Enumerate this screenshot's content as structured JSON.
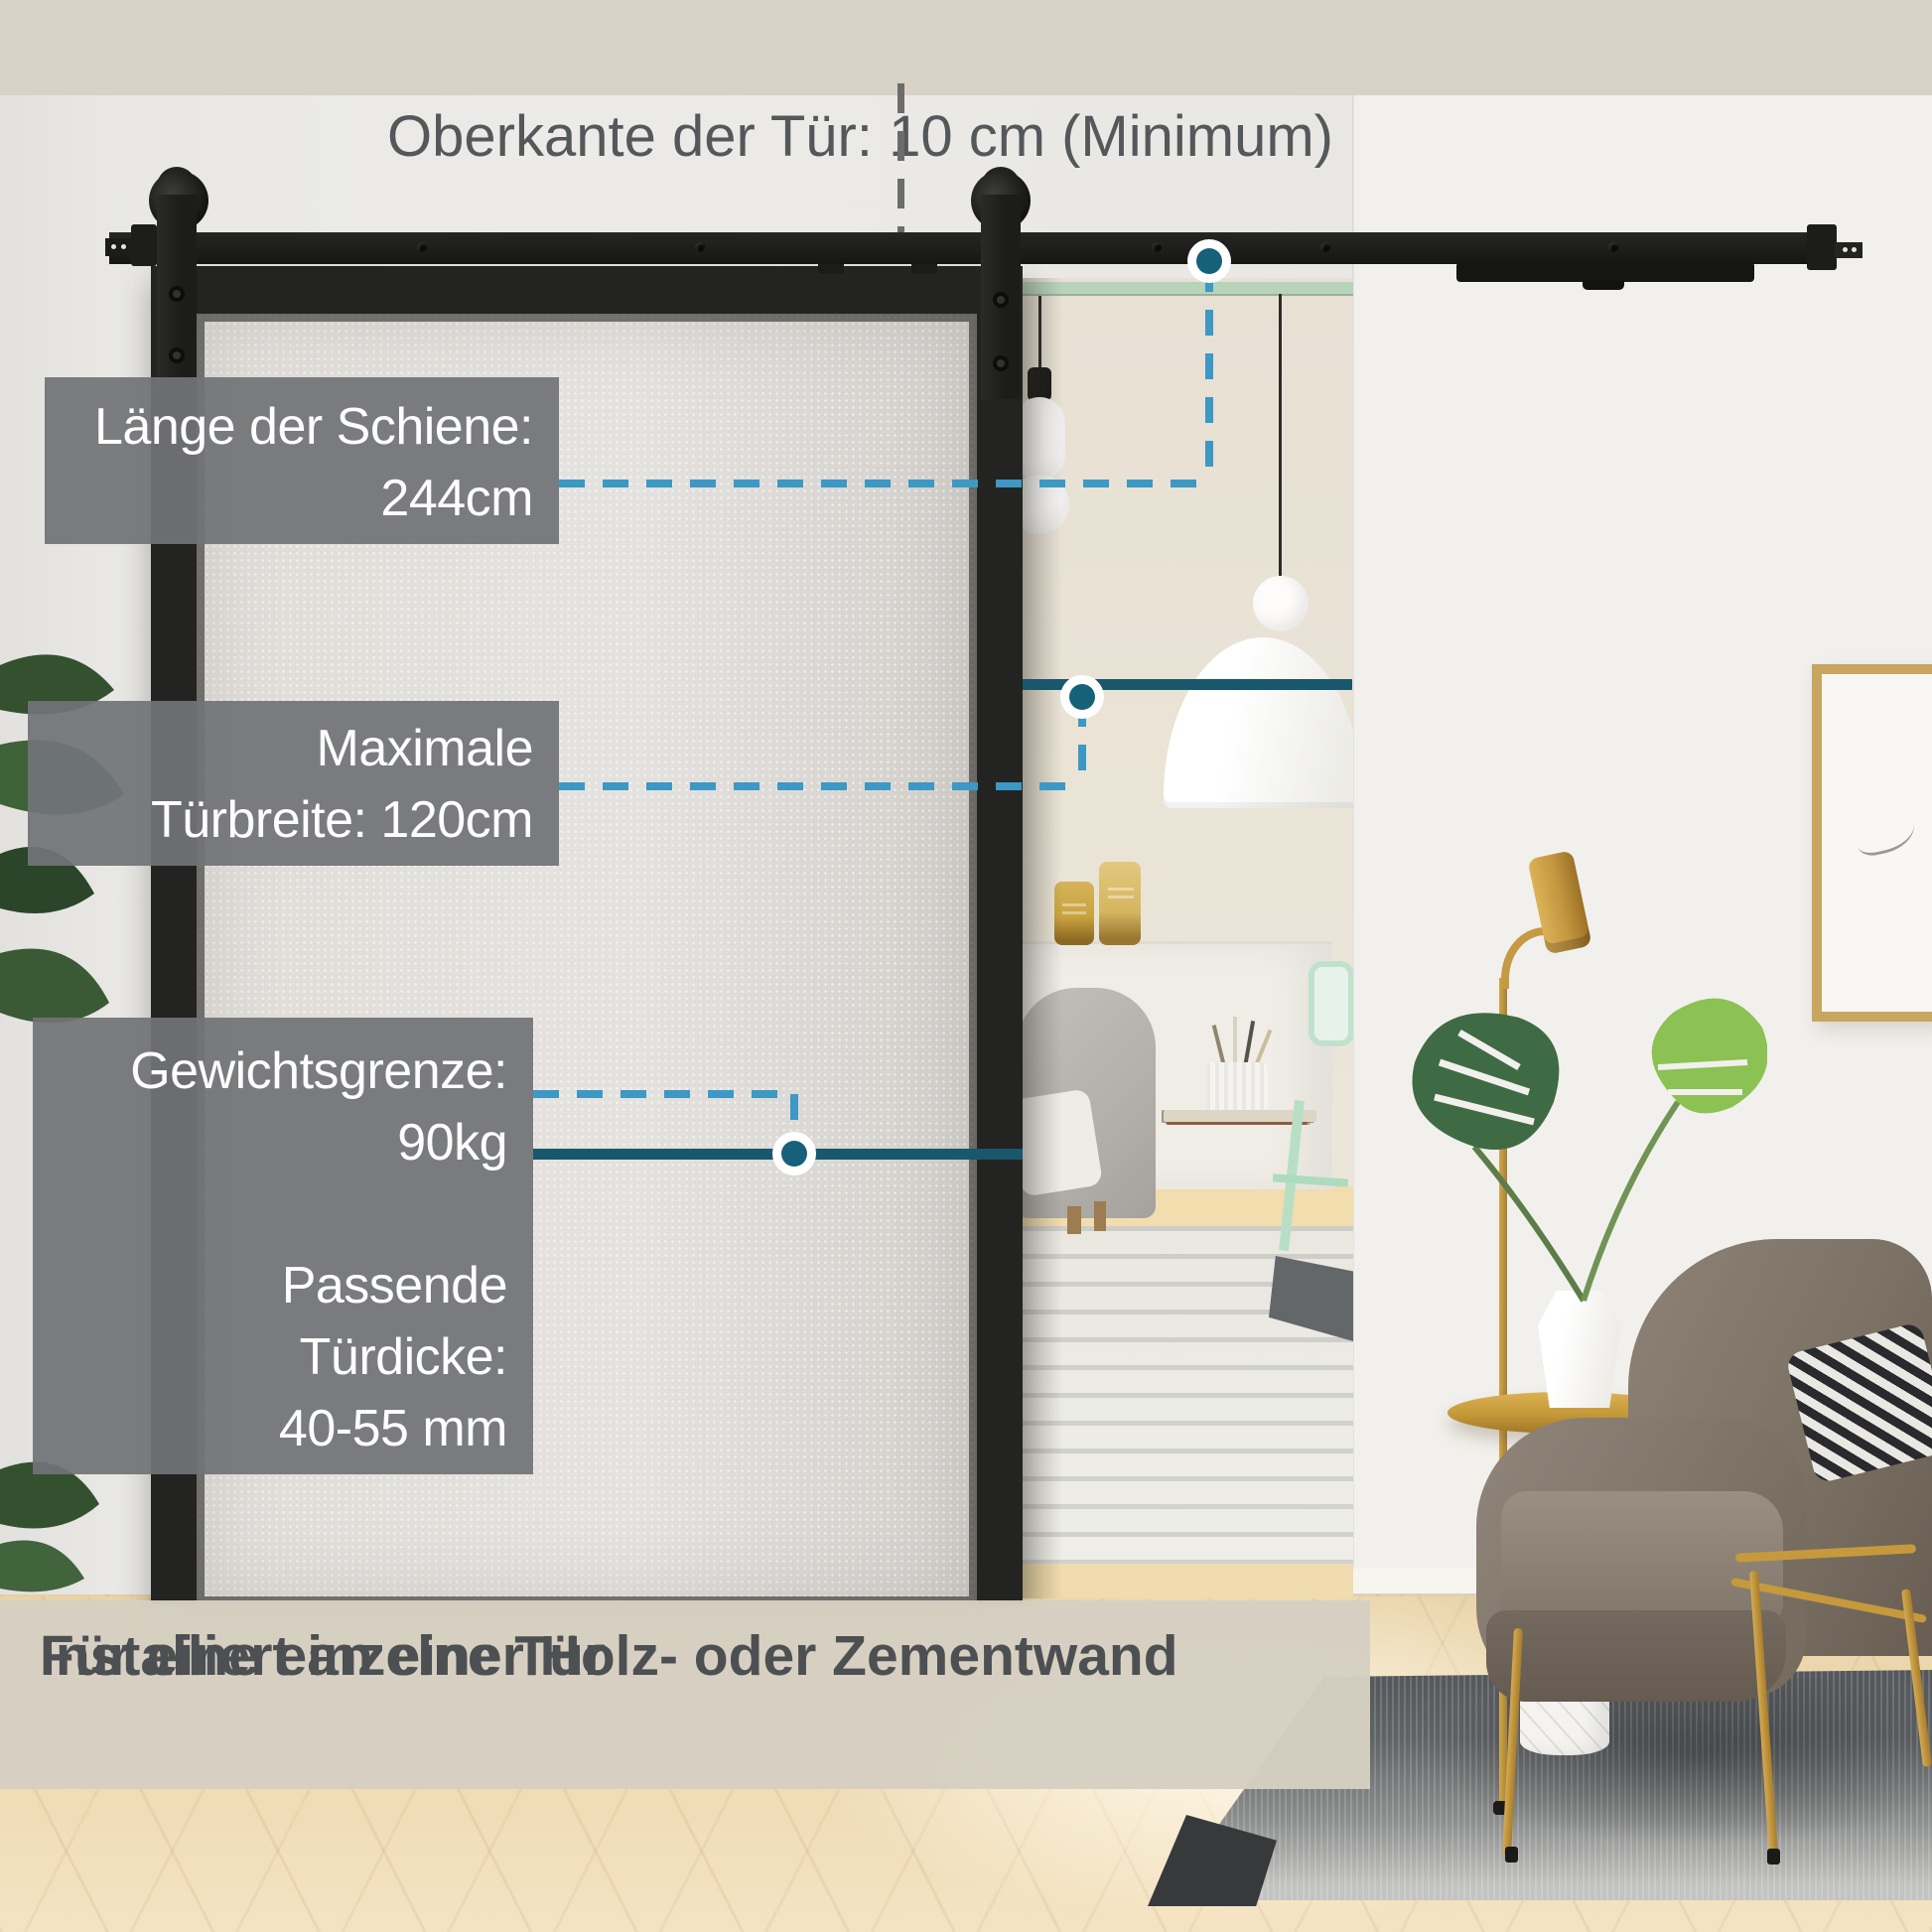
{
  "annotations": {
    "top_note": "Oberkante der Tür: 10 cm (Minimum)",
    "rail_length": {
      "label": "Länge der Schiene:",
      "value": "244cm"
    },
    "door_width": {
      "line1": "Maximale",
      "line2": "Türbreite: 120cm"
    },
    "weight_limit": {
      "label": "Gewichtsgrenze:",
      "value": "90kg"
    },
    "door_thickness": {
      "line1": "Passende",
      "line2": "Türdicke:",
      "line3": "40-55 mm"
    }
  },
  "banner": {
    "line1": "Für eine einzelne Tür",
    "line2": "Installiert an einer Holz- oder Zementwand"
  },
  "colors": {
    "dashed_line": "#3d98c4",
    "solid_line": "#19576c",
    "dot_fill": "#16607a",
    "label_box_bg": "rgba(113,115,118,0.93)",
    "banner_bg": "rgba(214,208,194,0.97)",
    "banner_text": "#4d5053",
    "note_text": "#55585b"
  }
}
